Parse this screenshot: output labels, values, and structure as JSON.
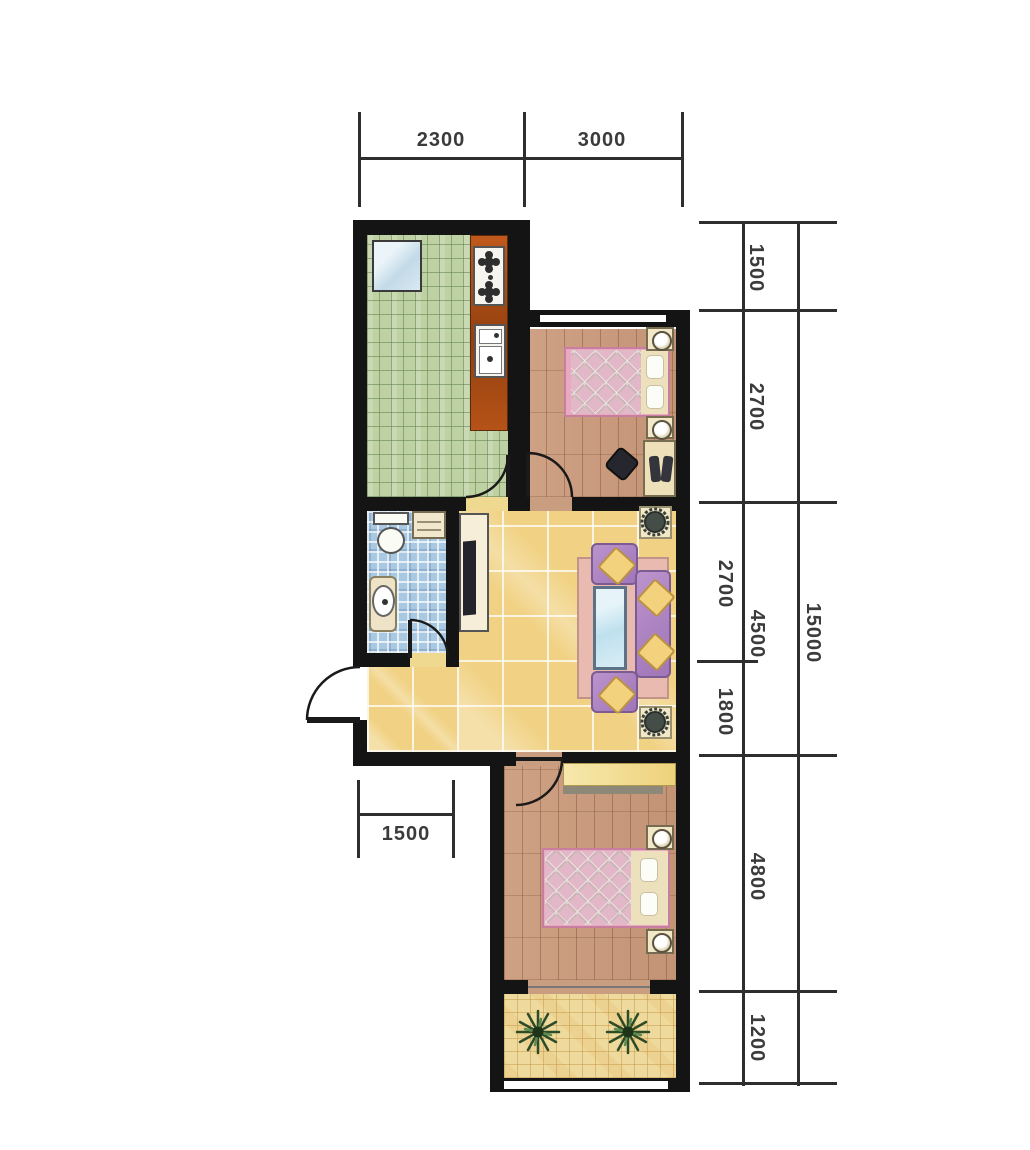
{
  "dimensions": {
    "top": [
      "2300",
      "3000"
    ],
    "right_segments": [
      "1500",
      "2700",
      "2700",
      "1800",
      "4800",
      "1200"
    ],
    "right_subtotal": "4500",
    "right_total": "15000",
    "bottom": [
      "1500"
    ]
  },
  "colors": {
    "wall": "#141414",
    "kitchen_floor": "#bdd1a2",
    "bathroom_floor": "#a9c9e3",
    "living_floor": "#f1d284",
    "bedroom_floor": "#c99d80",
    "balcony_floor": "#eeda9c",
    "bed_quilt": "#e2b8c8",
    "sofa": "#a076b8",
    "counter": "#b0541c",
    "dimension_text": "#3b3b3b"
  }
}
